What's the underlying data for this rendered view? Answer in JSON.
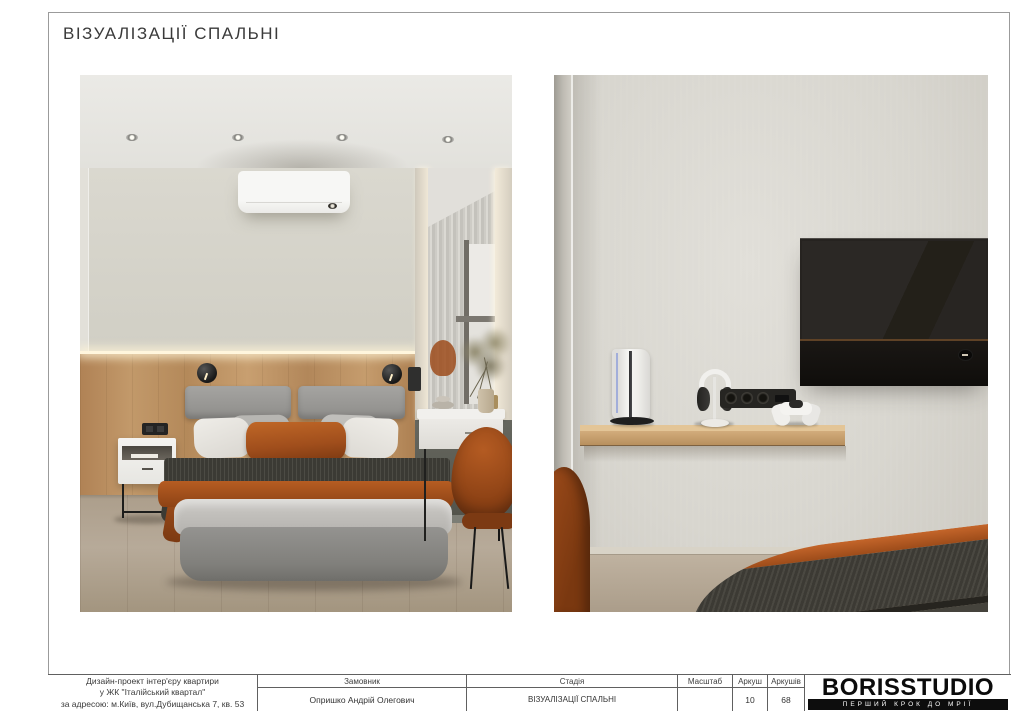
{
  "page": {
    "title": "ВІЗУАЛІЗАЦІЇ СПАЛЬНІ"
  },
  "title_block": {
    "project_info_line1": "Дизайн-проект інтер'єру квартири",
    "project_info_line2": "у ЖК \"Італійський квартал\"",
    "project_info_line3": "за адресою: м.Київ, вул.Дубищанська 7, кв. 53",
    "client_label": "Замовник",
    "client_value": "Опришко Андрій Олегович",
    "stage_label": "Стадія",
    "stage_value": "ВІЗУАЛІЗАЦІЇ СПАЛЬНІ",
    "scale_label": "Масштаб",
    "scale_value": "",
    "sheet_label": "Аркуш",
    "sheet_value": "10",
    "sheets_label": "Аркушів",
    "sheets_value": "68"
  },
  "logo": {
    "name": "BORISSTUDIO",
    "tagline": "ПЕРШИЙ КРОК ДО МРІЇ"
  },
  "palette": {
    "accent_rust": "#a8541e",
    "wood_panel": "#bf9765",
    "wall_beige": "#d5d3c9",
    "wall_gray": "#dcdad3",
    "tv_black": "#23201d",
    "knit_dark": "#3a3833",
    "floor_wood": "#b0a290"
  }
}
